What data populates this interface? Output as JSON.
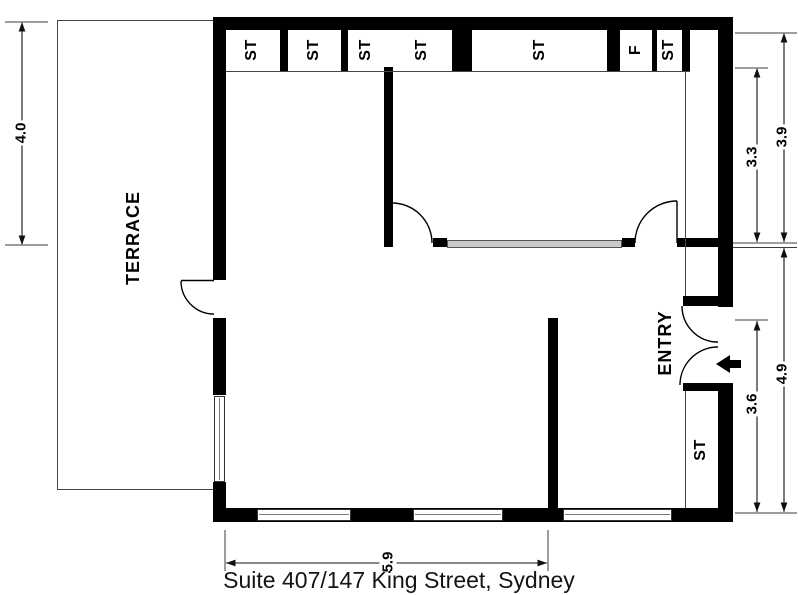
{
  "caption": "Suite 407/147 King Street, Sydney",
  "rooms": {
    "terrace_label": "TERRACE",
    "entry_label": "ENTRY"
  },
  "storage_row": [
    "ST",
    "ST",
    "ST",
    "ST",
    "ST",
    "F",
    "ST"
  ],
  "closet_label": "ST",
  "dimensions": {
    "terrace_side": "4.0",
    "right_top_outer": "3.9",
    "right_top_inner": "3.3",
    "right_bottom_outer": "4.9",
    "right_bottom_inner": "3.6",
    "bottom_width": "5.9"
  },
  "colors": {
    "wall": "#000000",
    "thin_line": "#454545",
    "glass": "#c9c9c9",
    "background": "#ffffff"
  }
}
